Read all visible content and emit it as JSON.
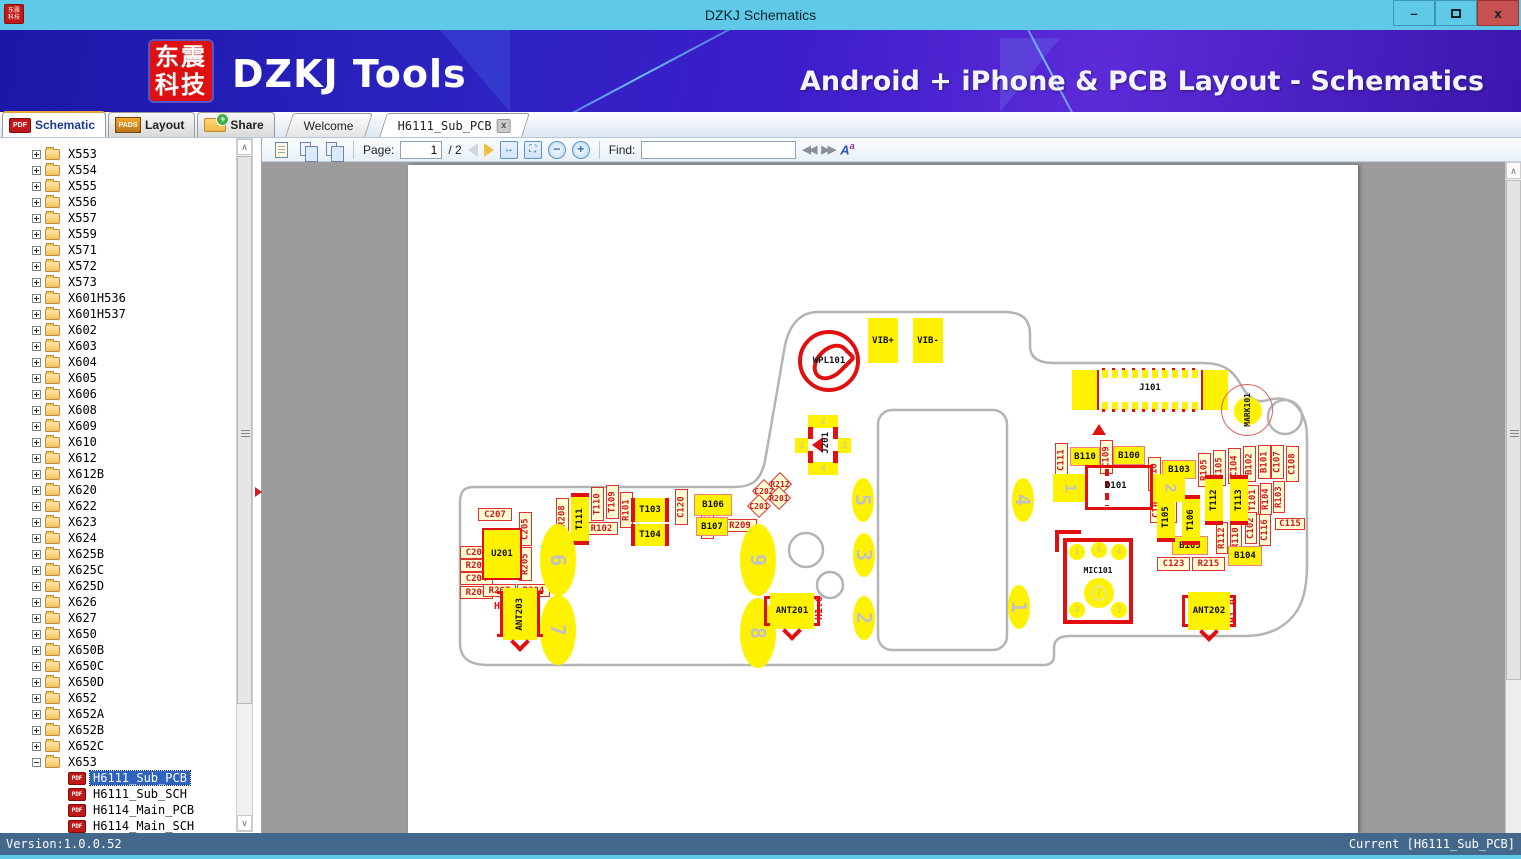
{
  "window": {
    "title": "DZKJ Schematics",
    "minimize": "–",
    "close": "x"
  },
  "banner": {
    "logo_line1": "东震",
    "logo_line2": "科技",
    "brand": "DZKJ Tools",
    "tagline": "Android + iPhone & PCB Layout - Schematics"
  },
  "tabs": {
    "panel": [
      {
        "label": "Schematic",
        "icon": "pdf",
        "active": true
      },
      {
        "label": "Layout",
        "icon": "pads",
        "active": false
      },
      {
        "label": "Share",
        "icon": "folder-share",
        "active": false
      }
    ],
    "documents": [
      {
        "label": "Welcome",
        "closable": false,
        "active": false
      },
      {
        "label": "H6111_Sub_PCB",
        "closable": true,
        "active": true,
        "close_glyph": "x"
      }
    ]
  },
  "tree": {
    "folders": [
      "X553",
      "X554",
      "X555",
      "X556",
      "X557",
      "X559",
      "X571",
      "X572",
      "X573",
      "X601H536",
      "X601H537",
      "X602",
      "X603",
      "X604",
      "X605",
      "X606",
      "X608",
      "X609",
      "X610",
      "X612",
      "X612B",
      "X620",
      "X622",
      "X623",
      "X624",
      "X625B",
      "X625C",
      "X625D",
      "X626",
      "X627",
      "X650",
      "X650B",
      "X650C",
      "X650D",
      "X652",
      "X652A",
      "X652B",
      "X652C",
      "X653"
    ],
    "expanded_folder": "X653",
    "docs": [
      "H6111_Sub_PCB",
      "H6111_Sub_SCH",
      "H6114_Main_PCB",
      "H6114_Main_SCH"
    ],
    "selected_doc": "H6111_Sub_PCB"
  },
  "toolbar": {
    "page_label": "Page:",
    "page_value": "1",
    "page_total": "/ 2",
    "find_label": "Find:",
    "find_value": "",
    "zoom_out": "−",
    "zoom_in": "+",
    "fit_width": "↔",
    "fit_page": "⛶",
    "find_prev": "◀◀",
    "find_next": "▶▶",
    "case_button": "A",
    "case_sup": "a"
  },
  "statusbar": {
    "version": "Version:1.0.0.52",
    "current": "Current [H6111_Sub_PCB]"
  },
  "pcb": {
    "special": {
      "u201": "U201",
      "wpl101": "WPL101",
      "j101": "J101",
      "mark101": "MARK101",
      "j201": "J201",
      "d101": "D101",
      "mic101": "MIC101",
      "ant201": "ANT201",
      "ant202": "ANT202",
      "ant203": "ANT203",
      "j201_pads": [
        "1",
        "2",
        "3",
        "4"
      ],
      "d101_pads": [
        "1",
        "2"
      ],
      "mic_pins": [
        "1",
        "6",
        "4",
        "7",
        "2",
        "3"
      ]
    },
    "components": [
      [
        "lbl",
        "C207",
        70,
        343,
        34,
        13
      ],
      [
        "lbl",
        "C206",
        52,
        381,
        33,
        13
      ],
      [
        "lbl",
        "R203",
        52,
        394,
        33,
        13
      ],
      [
        "lbl",
        "C204",
        52,
        407,
        33,
        13
      ],
      [
        "lbl",
        "R206",
        52,
        421,
        33,
        13
      ],
      [
        "lbl",
        "R207",
        75,
        419,
        33,
        13
      ],
      [
        "lbl",
        "R204",
        109,
        419,
        33,
        13
      ],
      [
        "lbl",
        "R102",
        177,
        357,
        33,
        13
      ],
      [
        "lbl",
        "R209",
        315,
        354,
        34,
        13
      ],
      [
        "lbl",
        "C123",
        749,
        392,
        33,
        14
      ],
      [
        "lbl",
        "R215",
        784,
        392,
        33,
        14
      ],
      [
        "lbl",
        "C115",
        867,
        353,
        30,
        12
      ],
      [
        "vlbl",
        "C205",
        111,
        347,
        13,
        34
      ],
      [
        "vlbl",
        "R205",
        111,
        382,
        13,
        34
      ],
      [
        "vlbl",
        "R208",
        148,
        333,
        13,
        36
      ],
      [
        "vlbl",
        "T110",
        183,
        322,
        13,
        34
      ],
      [
        "vlbl",
        "T109",
        198,
        320,
        13,
        34
      ],
      [
        "vlbl",
        "R101",
        212,
        327,
        13,
        36
      ],
      [
        "vlbl",
        "C120",
        267,
        324,
        13,
        36
      ],
      [
        "vlbl",
        "C121",
        293,
        338,
        13,
        36
      ],
      [
        "vlbl",
        "C111",
        647,
        278,
        13,
        34
      ],
      [
        "vlbl",
        "C109",
        692,
        275,
        13,
        34
      ],
      [
        "vlbl",
        "R210",
        740,
        292,
        13,
        34
      ],
      [
        "vlbl",
        "C103",
        742,
        327,
        13,
        31
      ],
      [
        "vlbl",
        "L101",
        756,
        327,
        13,
        31
      ],
      [
        "vlbl",
        "R105",
        790,
        288,
        13,
        34
      ],
      [
        "vlbl",
        "C105",
        805,
        285,
        13,
        36
      ],
      [
        "vlbl",
        "C104",
        820,
        283,
        13,
        36
      ],
      [
        "vlbl",
        "B102",
        835,
        281,
        13,
        36
      ],
      [
        "vlbl",
        "B101",
        850,
        280,
        13,
        34
      ],
      [
        "vlbl",
        "C107",
        863,
        280,
        13,
        34
      ],
      [
        "vlbl",
        "C108",
        878,
        281,
        13,
        36
      ],
      [
        "vlbl",
        "T101",
        839,
        320,
        12,
        30
      ],
      [
        "vlbl",
        "R104",
        852,
        318,
        12,
        32
      ],
      [
        "vlbl",
        "R103",
        865,
        316,
        12,
        32
      ],
      [
        "vlbl",
        "C102",
        837,
        347,
        12,
        32
      ],
      [
        "vlbl",
        "C116",
        851,
        349,
        12,
        32
      ],
      [
        "vlbl",
        "R112",
        808,
        357,
        12,
        32
      ],
      [
        "vlbl",
        "R110",
        822,
        357,
        12,
        32
      ],
      [
        "pad",
        "B106",
        286,
        329,
        38,
        22
      ],
      [
        "pad",
        "B107",
        288,
        352,
        32,
        19
      ],
      [
        "pad",
        "B110",
        662,
        282,
        30,
        19
      ],
      [
        "pad",
        "B100",
        705,
        281,
        32,
        19
      ],
      [
        "pad",
        "B103",
        754,
        295,
        34,
        19
      ],
      [
        "pad",
        "B105",
        764,
        371,
        36,
        19
      ],
      [
        "pad",
        "B104",
        820,
        381,
        34,
        20
      ],
      [
        "ypad",
        "VIB+",
        460,
        153,
        30,
        45
      ],
      [
        "ypad",
        "VIB-",
        505,
        153,
        30,
        45
      ],
      [
        "vpad",
        "T111",
        163,
        328,
        18,
        52
      ],
      [
        "vpad",
        "T105",
        749,
        327,
        18,
        50
      ],
      [
        "vpad",
        "T106",
        774,
        330,
        18,
        50
      ],
      [
        "vpad",
        "T112",
        797,
        310,
        18,
        50
      ],
      [
        "vpad",
        "T113",
        822,
        310,
        18,
        50
      ],
      [
        "hpad",
        "T103",
        223,
        333,
        38,
        24
      ],
      [
        "hpad",
        "T104",
        223,
        359,
        38,
        22
      ],
      [
        "oval",
        "6",
        132,
        359,
        36,
        72
      ],
      [
        "oval",
        "7",
        132,
        430,
        36,
        70
      ],
      [
        "oval",
        "9",
        332,
        359,
        36,
        72
      ],
      [
        "oval",
        "8",
        332,
        433,
        36,
        70
      ],
      [
        "oval",
        "5",
        444,
        313,
        22,
        44
      ],
      [
        "oval",
        "4",
        604,
        313,
        22,
        44
      ],
      [
        "oval",
        "3",
        445,
        368,
        22,
        44
      ],
      [
        "oval",
        "2",
        445,
        431,
        22,
        44
      ],
      [
        "oval",
        "1",
        600,
        420,
        22,
        44
      ],
      [
        "dia",
        "R212",
        358,
        310,
        28,
        18
      ],
      [
        "dia",
        "C202",
        342,
        317,
        28,
        18
      ],
      [
        "dia",
        "R201",
        357,
        324,
        28,
        18
      ],
      [
        "dia",
        "C201",
        337,
        332,
        28,
        18
      ],
      [
        "redt",
        "H1.0",
        84,
        435,
        28,
        12
      ],
      [
        "redtv",
        "H1.0",
        406,
        428,
        11,
        30
      ],
      [
        "redtv",
        "H1.0",
        820,
        431,
        11,
        30
      ],
      [
        "tri",
        "",
        684,
        259,
        14,
        12
      ]
    ]
  }
}
